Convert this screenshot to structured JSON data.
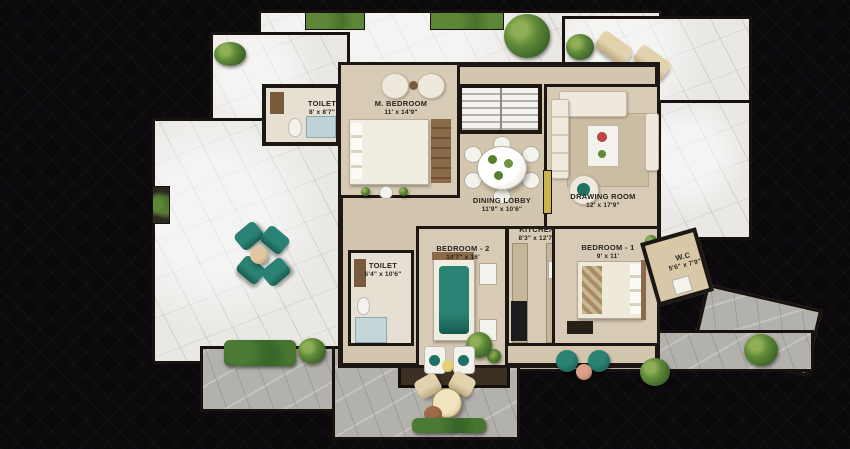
{
  "scene": {
    "type": "apartment-floor-plan-top-view",
    "background": "#0b090c"
  },
  "palette": {
    "backdrop": "#0b090c",
    "marble_floor": "#e9e8e5",
    "stone_terrace": "#b3b1ac",
    "interior_floor": "#d8cbb5",
    "wall": "#1c1712",
    "wood_accent": "#7a5a3c",
    "teal_furniture": "#1f7163",
    "plant_green": "#5f8a39",
    "white_furniture": "#f4f2ec",
    "yellow_accent": "#c9b54b"
  },
  "rooms": [
    {
      "id": "toilet-top",
      "name": "TOILET",
      "dims": "8' x 8'7\""
    },
    {
      "id": "m-bedroom",
      "name": "M. BEDROOM",
      "dims": "11' x 14'9\""
    },
    {
      "id": "dining-lobby",
      "name": "DINING LOBBY",
      "dims": "11'9\" x 10'6\""
    },
    {
      "id": "drawing-room",
      "name": "DRAWING ROOM",
      "dims": "12' x 17'9\""
    },
    {
      "id": "kitchen",
      "name": "KITCHEN",
      "dims": "8'3\" x 12'7\""
    },
    {
      "id": "bedroom-2",
      "name": "BEDROOM - 2",
      "dims": "10'7\" x 16'"
    },
    {
      "id": "bedroom-1",
      "name": "BEDROOM - 1",
      "dims": "9' x 11'"
    },
    {
      "id": "toilet-2",
      "name": "TOILET",
      "dims": "6'4\" x 10'6\""
    },
    {
      "id": "wc",
      "name": "W.C",
      "dims": "5'6\" x 7'9\""
    }
  ]
}
